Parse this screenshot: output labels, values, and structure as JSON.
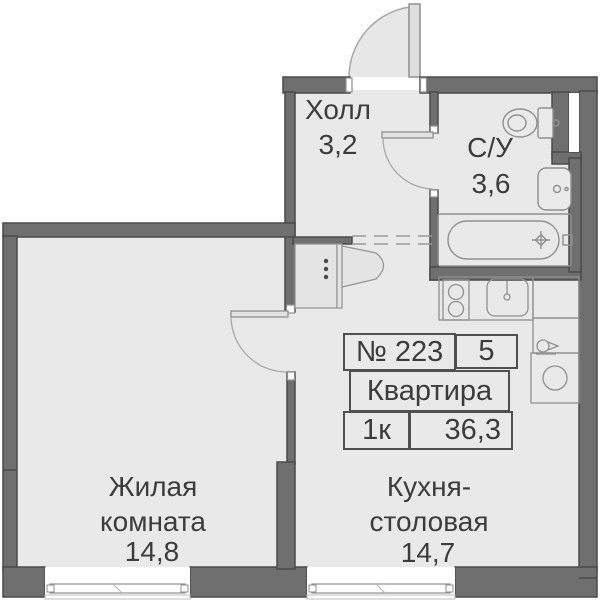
{
  "rooms": {
    "hall": {
      "name": "Холл",
      "area": "3,2"
    },
    "bathroom": {
      "name": "С/У",
      "area": "3,6"
    },
    "living": {
      "line1": "Жилая",
      "line2": "комната",
      "area": "14,8"
    },
    "kitchen": {
      "line1": "Кухня-",
      "line2": "столовая",
      "area": "14,7"
    }
  },
  "plate": {
    "number": "№ 223",
    "floor": "5",
    "type": "Квартира",
    "rooms": "1к",
    "total_area": "36,3"
  },
  "fixtures": [
    "entrance-door",
    "hall-closet",
    "bathroom-door",
    "toilet",
    "washbasin",
    "bathtub",
    "living-room-door",
    "stove",
    "kitchen-sink",
    "counter",
    "water-point",
    "washing-machine",
    "window-living-room",
    "window-kitchen"
  ],
  "colors": {
    "background": "#ffffff",
    "floor": "#e9e9e9",
    "wall": "#6f6f6f",
    "wall_outline": "#4a4a4a",
    "fixture_line": "#909090",
    "text": "#3c3c3c"
  }
}
